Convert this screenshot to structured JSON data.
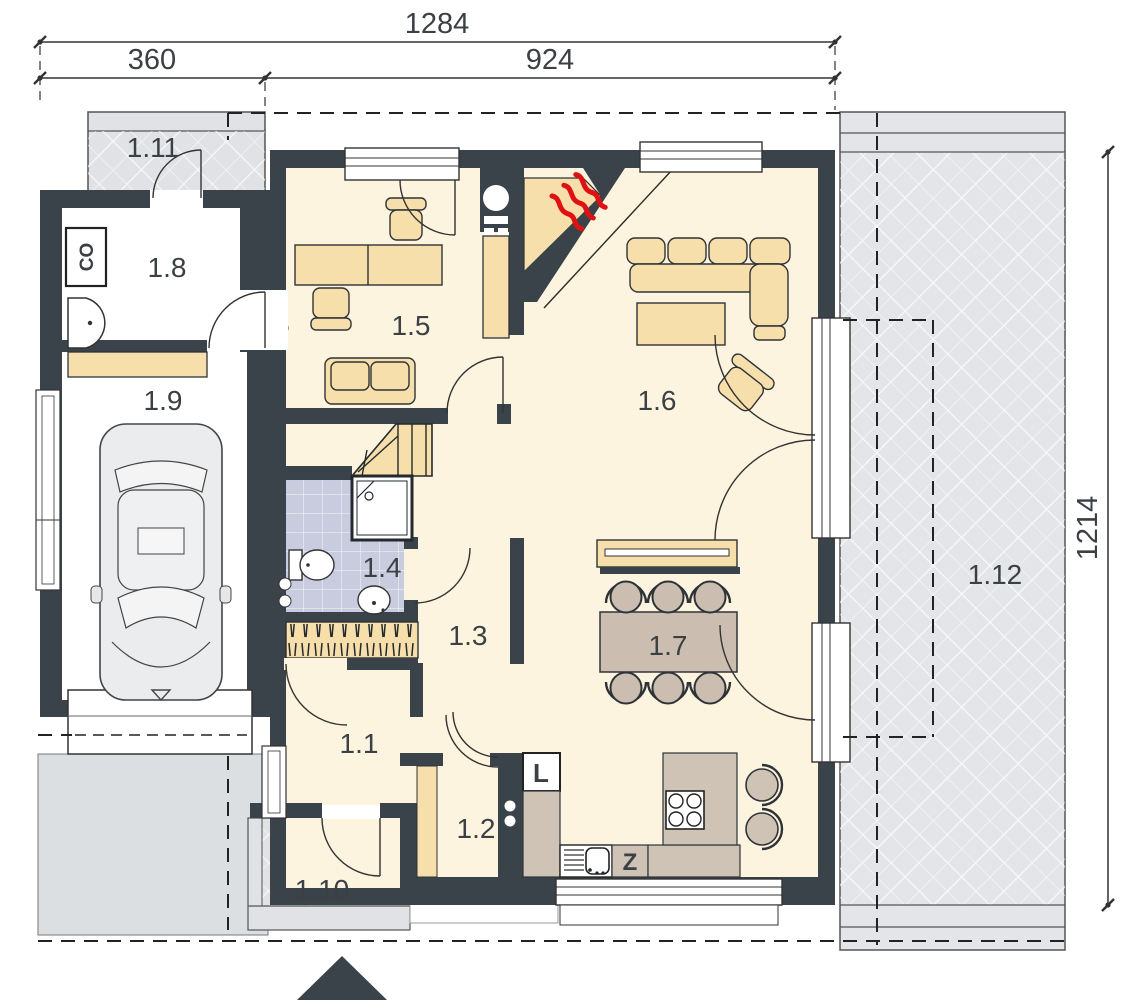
{
  "drawing": {
    "type": "house-ground-floor-plan",
    "dimensions": {
      "total_width": "1284",
      "left_section_width": "360",
      "right_section_width": "924",
      "side_depth": "1214"
    },
    "rooms": {
      "r1": "1.1",
      "r2": "1.2",
      "r3": "1.3",
      "r4": "1.4",
      "r5": "1.5",
      "r6": "1.6",
      "r7": "1.7",
      "r8": "1.8",
      "r9": "1.9",
      "r10": "1.10",
      "r11": "1.11",
      "r12": "1.12"
    },
    "appliances": {
      "boiler": "CO",
      "fridge": "L",
      "dishwasher": "Z"
    },
    "colors": {
      "wall": "#3a434a",
      "floor": "#fcf4df",
      "furniture": "#f7dfab",
      "counter": "#cfc3b6",
      "bath_tile": "#c9cbde",
      "paving": "#e3e5e8",
      "flame": "#e01111"
    }
  }
}
